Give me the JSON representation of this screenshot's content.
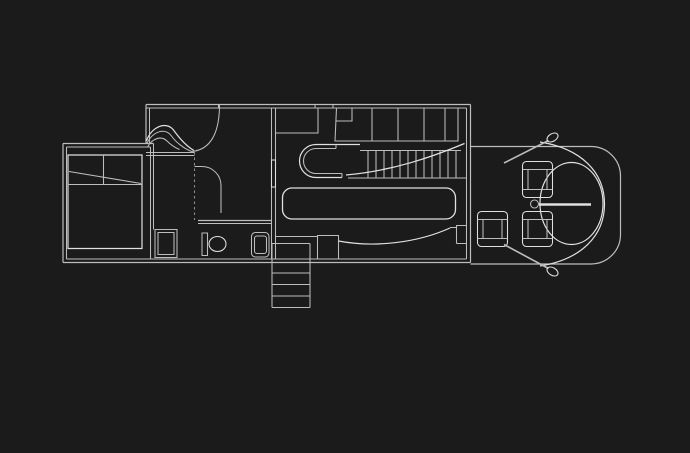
{
  "canvas": {
    "width": 690,
    "height": 453,
    "background": "#1b1b1b",
    "colors": {
      "base": "#bdbdbd",
      "bright": "#e0e0e0",
      "dim": "#8e8e8e"
    }
  },
  "plan": {
    "elements": [
      {
        "name": "wall-bedroom-left-outer",
        "d": "M63,143.5 V262.5",
        "w": 1.2
      },
      {
        "name": "wall-bedroom-left-inner",
        "d": "M66.5,147 V259"
      },
      {
        "name": "wall-bedroom-top-outer",
        "d": "M63,143.5 H153.5",
        "w": 1.2
      },
      {
        "name": "wall-bedroom-top-inner",
        "d": "M66.5,147 H150.5"
      },
      {
        "name": "wall-bedroom-right-outer",
        "d": "M153.5,143.5 V229.5"
      },
      {
        "name": "wall-bedroom-right-inner",
        "d": "M150.5,147 V258.5"
      },
      {
        "name": "wall-house-bottom-outer",
        "d": "M63,262.5 H470.5",
        "w": 1.2
      },
      {
        "name": "wall-house-bottom-inner",
        "d": "M66.5,259 H466.5"
      },
      {
        "name": "wall-main-left-outer",
        "d": "M146,104.5 V143.5",
        "w": 1.2
      },
      {
        "name": "wall-main-left-inner",
        "d": "M149.5,108 V143.5"
      },
      {
        "name": "wall-main-top-outer",
        "d": "M146,104.5 H470.5",
        "w": 1.2
      },
      {
        "name": "wall-main-top-inner",
        "d": "M146,108 H466.5"
      },
      {
        "name": "wall-main-right-outer",
        "d": "M470.5,104.5 V262.5",
        "w": 1.2
      },
      {
        "name": "wall-main-right-inner",
        "d": "M466.5,108 V259"
      },
      {
        "name": "wall-partition-outer",
        "d": "M271.5,108 V259"
      },
      {
        "name": "wall-partition-inner",
        "d": "M275.5,108 V259"
      },
      {
        "name": "wall-partition-door",
        "d": "M271.5,160 H275.5 V187 H271.5 Z",
        "tone": "bright"
      },
      {
        "name": "wall-tick-1",
        "d": "M218.5,104.5 V108"
      },
      {
        "name": "wall-tick-2",
        "d": "M315,104.5 V108"
      },
      {
        "name": "wall-tick-3",
        "d": "M333,104.5 V108"
      },
      {
        "name": "bed-outline",
        "d": "M68,155 H142 V248.5 H68 Z",
        "tone": "bright",
        "w": 1.2
      },
      {
        "name": "bed-pillow-line",
        "d": "M103.5,155 V184"
      },
      {
        "name": "bed-fold-line",
        "d": "M68,184.5 H142"
      },
      {
        "name": "bed-fold-diagonal",
        "d": "M69,171.5 L141,183.5"
      },
      {
        "name": "wave-wall-1",
        "d": "M146.5,141 C151,127 166,120.5 173.5,130 C178.5,137 186,146 194,150.5",
        "tone": "bright",
        "w": 1.2
      },
      {
        "name": "wave-wall-2",
        "d": "M146.5,144 C152.5,131.5 165,127 171.5,136 C176,142.5 184,148.5 191.5,151.5"
      },
      {
        "name": "wave-wall-3",
        "d": "M147.5,147 C152.5,138 161.5,135.5 167,141 C170,144 174.5,147.5 179.5,149.5"
      },
      {
        "name": "wave-riser",
        "d": "M219.5,105 C219.5,132 211,150 191.5,151.5"
      },
      {
        "name": "hall-ledge-top",
        "d": "M146,152.5 H194.5"
      },
      {
        "name": "hall-ledge-bottom",
        "d": "M146,155.5 H194.5"
      },
      {
        "name": "hall-dashed-line",
        "d": "M194.5,152 V220",
        "tone": "dim",
        "dash": "2.5,3"
      },
      {
        "name": "hall-curved-wall",
        "d": "M194.5,166.5 H202 A19,19 0 0 1 221,185.5 V213"
      },
      {
        "name": "bathroom-wall-top-a",
        "d": "M198,220.5 H271.5",
        "w": 1.2
      },
      {
        "name": "bathroom-wall-top-b",
        "d": "M198,223.5 H271.5"
      },
      {
        "name": "closet-outer",
        "d": "M155,229.5 H177 V257.5 H155 Z"
      },
      {
        "name": "closet-inner",
        "d": "M158,232.5 H174 V254.5 H158 Z"
      },
      {
        "name": "toilet-tank",
        "d": "M202,233 H207.5 V255.5 H202 Z"
      },
      {
        "name": "toilet-bowl",
        "cx": 217.5,
        "cy": 244,
        "rx": 8.5,
        "ry": 7.5,
        "tone": "bright"
      },
      {
        "name": "sink-outer",
        "d": "M255.5,232.5 H265 A4,4 0 0 1 269,236.5 V253 A4,4 0 0 1 265,257 H255.5 A4,4 0 0 1 251.5,253 V236.5 A4,4 0 0 1 255.5,232.5 Z"
      },
      {
        "name": "sink-inner",
        "d": "M257,236 H264 A2.5,2.5 0 0 1 266.5,238.5 V251 A2.5,2.5 0 0 1 264,253.5 H257 A2.5,2.5 0 0 1 254.5,251 V238.5 A2.5,2.5 0 0 1 257,236 Z"
      },
      {
        "name": "kitchen-corner-closet",
        "d": "M275.5,133 H318 V108"
      },
      {
        "name": "kitchen-counter-outline",
        "d": "M336.5,108 L335,141 L458,141 L458,108"
      },
      {
        "name": "kitchen-counter-left-box",
        "d": "M336,121 H352 V108"
      },
      {
        "name": "kitchen-counter-div-1",
        "d": "M372,108 V141"
      },
      {
        "name": "kitchen-counter-div-2",
        "d": "M398,108 V141"
      },
      {
        "name": "kitchen-counter-div-3",
        "d": "M424,108 V141"
      },
      {
        "name": "kitchen-counter-div-4",
        "d": "M445,108 V141"
      },
      {
        "name": "island-outer",
        "d": "M360,144.5 H316 A16.5,16.5 0 0 0 316,177.5 H342",
        "tone": "bright",
        "w": 1.2
      },
      {
        "name": "island-inner",
        "d": "M336,148.5 H316 A12.5,12.5 0 0 0 316,173.5 H342 M336,144.5 V148.5 M342,173.5 V177.5"
      },
      {
        "name": "stair-top-line",
        "d": "M360,150.5 H461"
      },
      {
        "name": "stair-bottom-line",
        "d": "M348,178 H466.5"
      },
      {
        "name": "stair-treads",
        "d": "M368,150.5 V178 M376,150.5 V178 M384,150.5 V178 M392,150.5 V178 M400,150.5 V178 M408,150.5 V178 M416,150.5 V178 M424,150.5 V178 M432,150.5 V178 M440,150.5 V178 M448,150.5 V178 M456,150.5 V178"
      },
      {
        "name": "stair-swoosh",
        "d": "M346,175 C392,171 432,157 464.5,143.5",
        "tone": "bright",
        "w": 1.3
      },
      {
        "name": "dining-table",
        "d": "M292,188 H446 A9.5,9.5 0 0 1 455.5,197.5 V209.5 A9.5,9.5 0 0 1 446,219 H292 A9.5,9.5 0 0 1 282.5,209.5 V197.5 A9.5,9.5 0 0 1 292,188 Z",
        "tone": "bright",
        "w": 1.3
      },
      {
        "name": "landing-step",
        "d": "M317.5,259 V235.5 H338.5 V259"
      },
      {
        "name": "landing-line",
        "d": "M275.5,236.5 H317.5"
      },
      {
        "name": "bench-curve",
        "d": "M338.5,241 C375,248 418,242.5 450,228",
        "tone": "bright",
        "w": 1.2
      },
      {
        "name": "bench-end",
        "d": "M450,227.5 H456.5 M456.5,243.5 V225.5 H466.5 M456.5,243.5 H466.5"
      },
      {
        "name": "exterior-stair-sides",
        "d": "M272,243.5 V307.5 M310,243.5 V307.5"
      },
      {
        "name": "exterior-stair-treads",
        "d": "M272,243.5 H310 M272,273 H310 M272,284.5 H310 M272,296 H310 M272,307.5 H310"
      },
      {
        "name": "terrace-outline",
        "d": "M470.5,146.5 H591 A29.5,29.5 0 0 1 620.5,176 V234.5 A29.5,29.5 0 0 1 591,264 H470.5",
        "w": 1.2
      },
      {
        "name": "terrace-bow",
        "d": "M540,142 C581,148.5 604.5,172 604.5,204 C604.5,236 581,259.5 540,266",
        "tone": "bright",
        "w": 1.2
      },
      {
        "name": "terrace-tree-circle",
        "cx": 571.5,
        "cy": 203.5,
        "rx": 31.5,
        "ry": 41,
        "tone": "bright",
        "w": 1.2
      },
      {
        "name": "sundial-circle",
        "cx": 534.5,
        "cy": 204,
        "rx": 4,
        "ry": 4
      },
      {
        "name": "sundial-needle",
        "d": "M539,204.5 H591",
        "tone": "bright",
        "w": 2.4
      },
      {
        "name": "chair-top-outer",
        "d": "M526.5,161.5 H548.5 A4,4 0 0 1 552.5,165.5 V193.5 A4,4 0 0 1 548.5,197.5 H526.5 A4,4 0 0 1 522.5,193.5 V165.5 A4,4 0 0 1 526.5,161.5 Z",
        "tone": "bright"
      },
      {
        "name": "chair-top-detail",
        "d": "M522.5,169.5 H552.5 M522.5,189.5 H552.5 M528,169.5 V189.5 M547,169.5 V189.5"
      },
      {
        "name": "chair-left-outer",
        "d": "M481.5,211.5 H503.5 A4,4 0 0 1 507.5,215.5 V242.5 A4,4 0 0 1 503.5,246.5 H481.5 A4,4 0 0 1 477.5,242.5 V215.5 A4,4 0 0 1 481.5,211.5 Z",
        "tone": "bright"
      },
      {
        "name": "chair-left-detail",
        "d": "M477.5,219.5 H507.5 M477.5,238.5 H507.5 M483,219.5 V238.5 M502,219.5 V238.5"
      },
      {
        "name": "chair-bottom-outer",
        "d": "M526.5,211.5 H548.5 A4,4 0 0 1 552.5,215.5 V242.5 A4,4 0 0 1 548.5,246.5 H526.5 A4,4 0 0 1 522.5,242.5 V215.5 A4,4 0 0 1 526.5,211.5 Z",
        "tone": "bright"
      },
      {
        "name": "chair-bottom-detail",
        "d": "M522.5,219.5 H552.5 M522.5,238.5 H552.5 M528,219.5 V238.5 M547,219.5 V238.5"
      },
      {
        "name": "oar-top-shaft",
        "d": "M504,163 L548.5,140.5",
        "w": 1.6
      },
      {
        "name": "oar-top-blade",
        "cx": 552.5,
        "cy": 137.5,
        "rx": 6,
        "ry": 3.8,
        "rot": -31,
        "tone": "bright"
      },
      {
        "name": "oar-bottom-shaft",
        "d": "M504,244.5 L548.5,268.5",
        "w": 1.6
      },
      {
        "name": "oar-bottom-blade",
        "cx": 552.5,
        "cy": 271.5,
        "rx": 6,
        "ry": 3.8,
        "rot": 31,
        "tone": "bright"
      }
    ]
  }
}
